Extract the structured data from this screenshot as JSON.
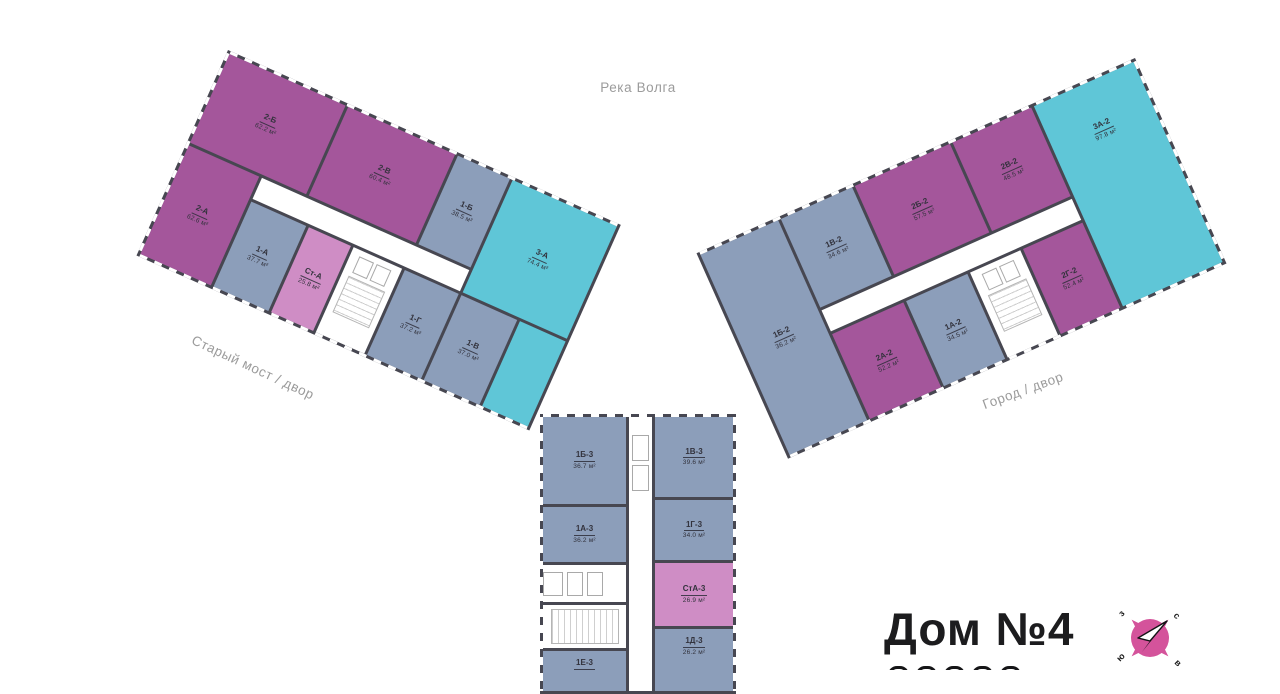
{
  "palette": {
    "two_room": "#a4569b",
    "one_room": "#8c9eba",
    "three_room": "#5fc6d7",
    "studio": "#cf8dc5",
    "wall": "#474751",
    "room_label": "#32323c",
    "annotation": "#9b9b9b",
    "title": "#1c1c1e",
    "compass": "#d4539b"
  },
  "annotations": {
    "river": "Река Волга",
    "left_street": "Старый мост / двор",
    "right_street": "Город / двор"
  },
  "title": {
    "text": "Дом №4"
  },
  "compass": {
    "west": "з",
    "north": "с",
    "south": "ю",
    "east": "в"
  },
  "wings": {
    "left": {
      "apartments": [
        {
          "id": "2-Б",
          "area": "62.2 м²",
          "type": "two_room"
        },
        {
          "id": "2-В",
          "area": "60.4 м²",
          "type": "two_room"
        },
        {
          "id": "1-Б",
          "area": "38.5 м²",
          "type": "one_room"
        },
        {
          "id": "3-А",
          "area": "74.4 м²",
          "type": "three_room"
        },
        {
          "id": "2-А",
          "area": "62.6 м²",
          "type": "two_room"
        },
        {
          "id": "1-А",
          "area": "37.7 м²",
          "type": "one_room"
        },
        {
          "id": "Ст-А",
          "area": "25.8 м²",
          "type": "studio"
        },
        {
          "id": "1-Г",
          "area": "37.2 м²",
          "type": "one_room"
        },
        {
          "id": "1-В",
          "area": "37.0 м²",
          "type": "one_room"
        }
      ]
    },
    "right": {
      "apartments": [
        {
          "id": "1Б-2",
          "area": "36.2 м²",
          "type": "one_room"
        },
        {
          "id": "1В-2",
          "area": "34.6 м²",
          "type": "one_room"
        },
        {
          "id": "2Б-2",
          "area": "57.5 м²",
          "type": "two_room"
        },
        {
          "id": "2В-2",
          "area": "48.5 м²",
          "type": "two_room"
        },
        {
          "id": "3А-2",
          "area": "97.8 м²",
          "type": "three_room"
        },
        {
          "id": "2А-2",
          "area": "52.2 м²",
          "type": "two_room"
        },
        {
          "id": "1А-2",
          "area": "34.5 м²",
          "type": "one_room"
        },
        {
          "id": "2Г-2",
          "area": "52.4 м²",
          "type": "two_room"
        }
      ]
    },
    "bottom": {
      "apartments": [
        {
          "id": "1Б-3",
          "area": "36.7 м²",
          "type": "one_room"
        },
        {
          "id": "1В-3",
          "area": "39.6 м²",
          "type": "one_room"
        },
        {
          "id": "1А-3",
          "area": "36.2 м²",
          "type": "one_room"
        },
        {
          "id": "1Г-3",
          "area": "34.0 м²",
          "type": "one_room"
        },
        {
          "id": "СтА-3",
          "area": "26.9 м²",
          "type": "studio"
        },
        {
          "id": "1Д-3",
          "area": "26.2 м²",
          "type": "one_room"
        },
        {
          "id": "1Е-3",
          "area": "",
          "type": "one_room"
        }
      ]
    }
  }
}
